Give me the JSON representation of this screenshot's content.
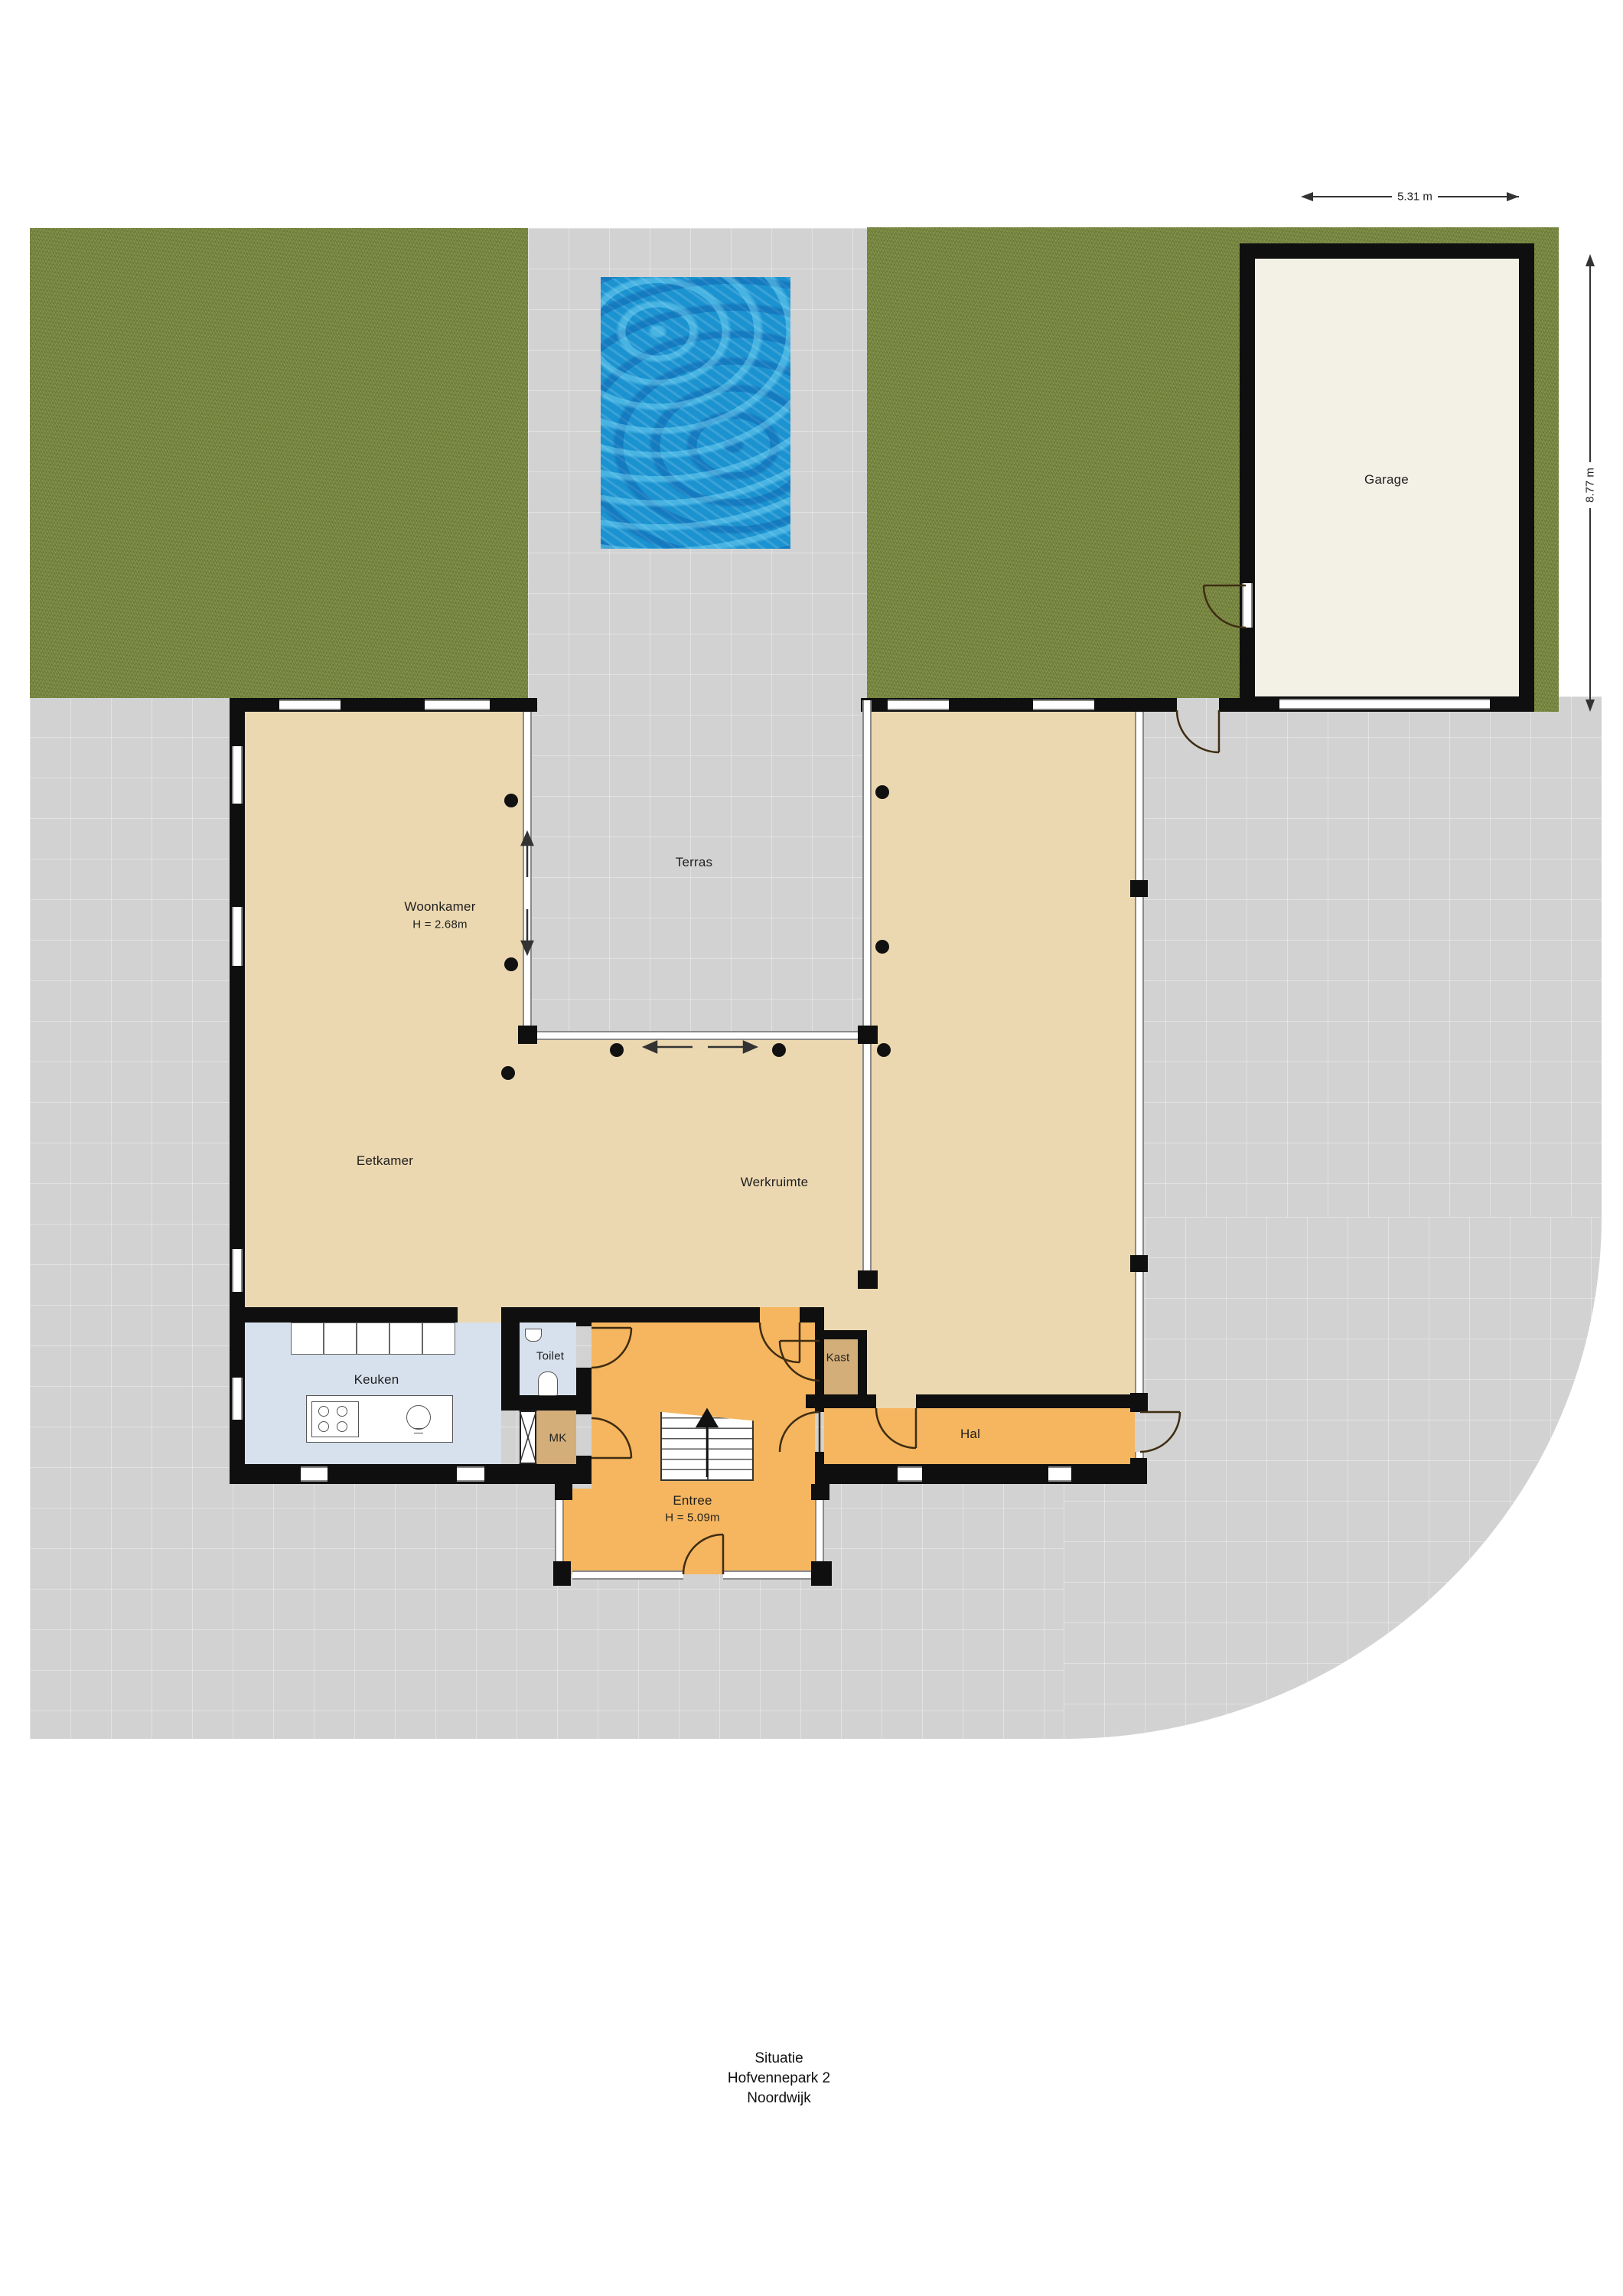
{
  "title_block": {
    "lines": [
      "Situatie",
      "Hofvennepark 2",
      "Noordwijk"
    ]
  },
  "dimensions": {
    "garage_width_label": "5.31 m",
    "garage_depth_label": "8.77 m"
  },
  "rooms": {
    "woonkamer": {
      "label": "Woonkamer",
      "ceiling_height": "H = 2.68m"
    },
    "terras": {
      "label": "Terras"
    },
    "eetkamer": {
      "label": "Eetkamer"
    },
    "werkruimte": {
      "label": "Werkruimte"
    },
    "keuken": {
      "label": "Keuken"
    },
    "toilet": {
      "label": "Toilet"
    },
    "mk": {
      "label": "MK"
    },
    "kast": {
      "label": "Kast"
    },
    "entree": {
      "label": "Entree",
      "ceiling_height": "H = 5.09m"
    },
    "hal": {
      "label": "Hal"
    },
    "garage": {
      "label": "Garage"
    }
  },
  "icons": {
    "stairs-up-arrow": "▲",
    "slide-arrow-left": "←",
    "slide-arrow-right": "→",
    "slide-arrow-up": "↑",
    "slide-arrow-down": "↓"
  },
  "colors": {
    "floor_tan": "#ecd8b0",
    "floor_orange": "#f6b65f",
    "floor_blue": "#d7e1ed",
    "floor_closet": "#d3ae79",
    "paving": "#d2d2d2",
    "grass": "#7d8c45",
    "pool_water": "#1b93d0",
    "garage_floor": "#f3f1e6",
    "wall": "#0f0f0f",
    "glass_frame": "#8a8a8a",
    "door_arc": "#3f2d12"
  }
}
